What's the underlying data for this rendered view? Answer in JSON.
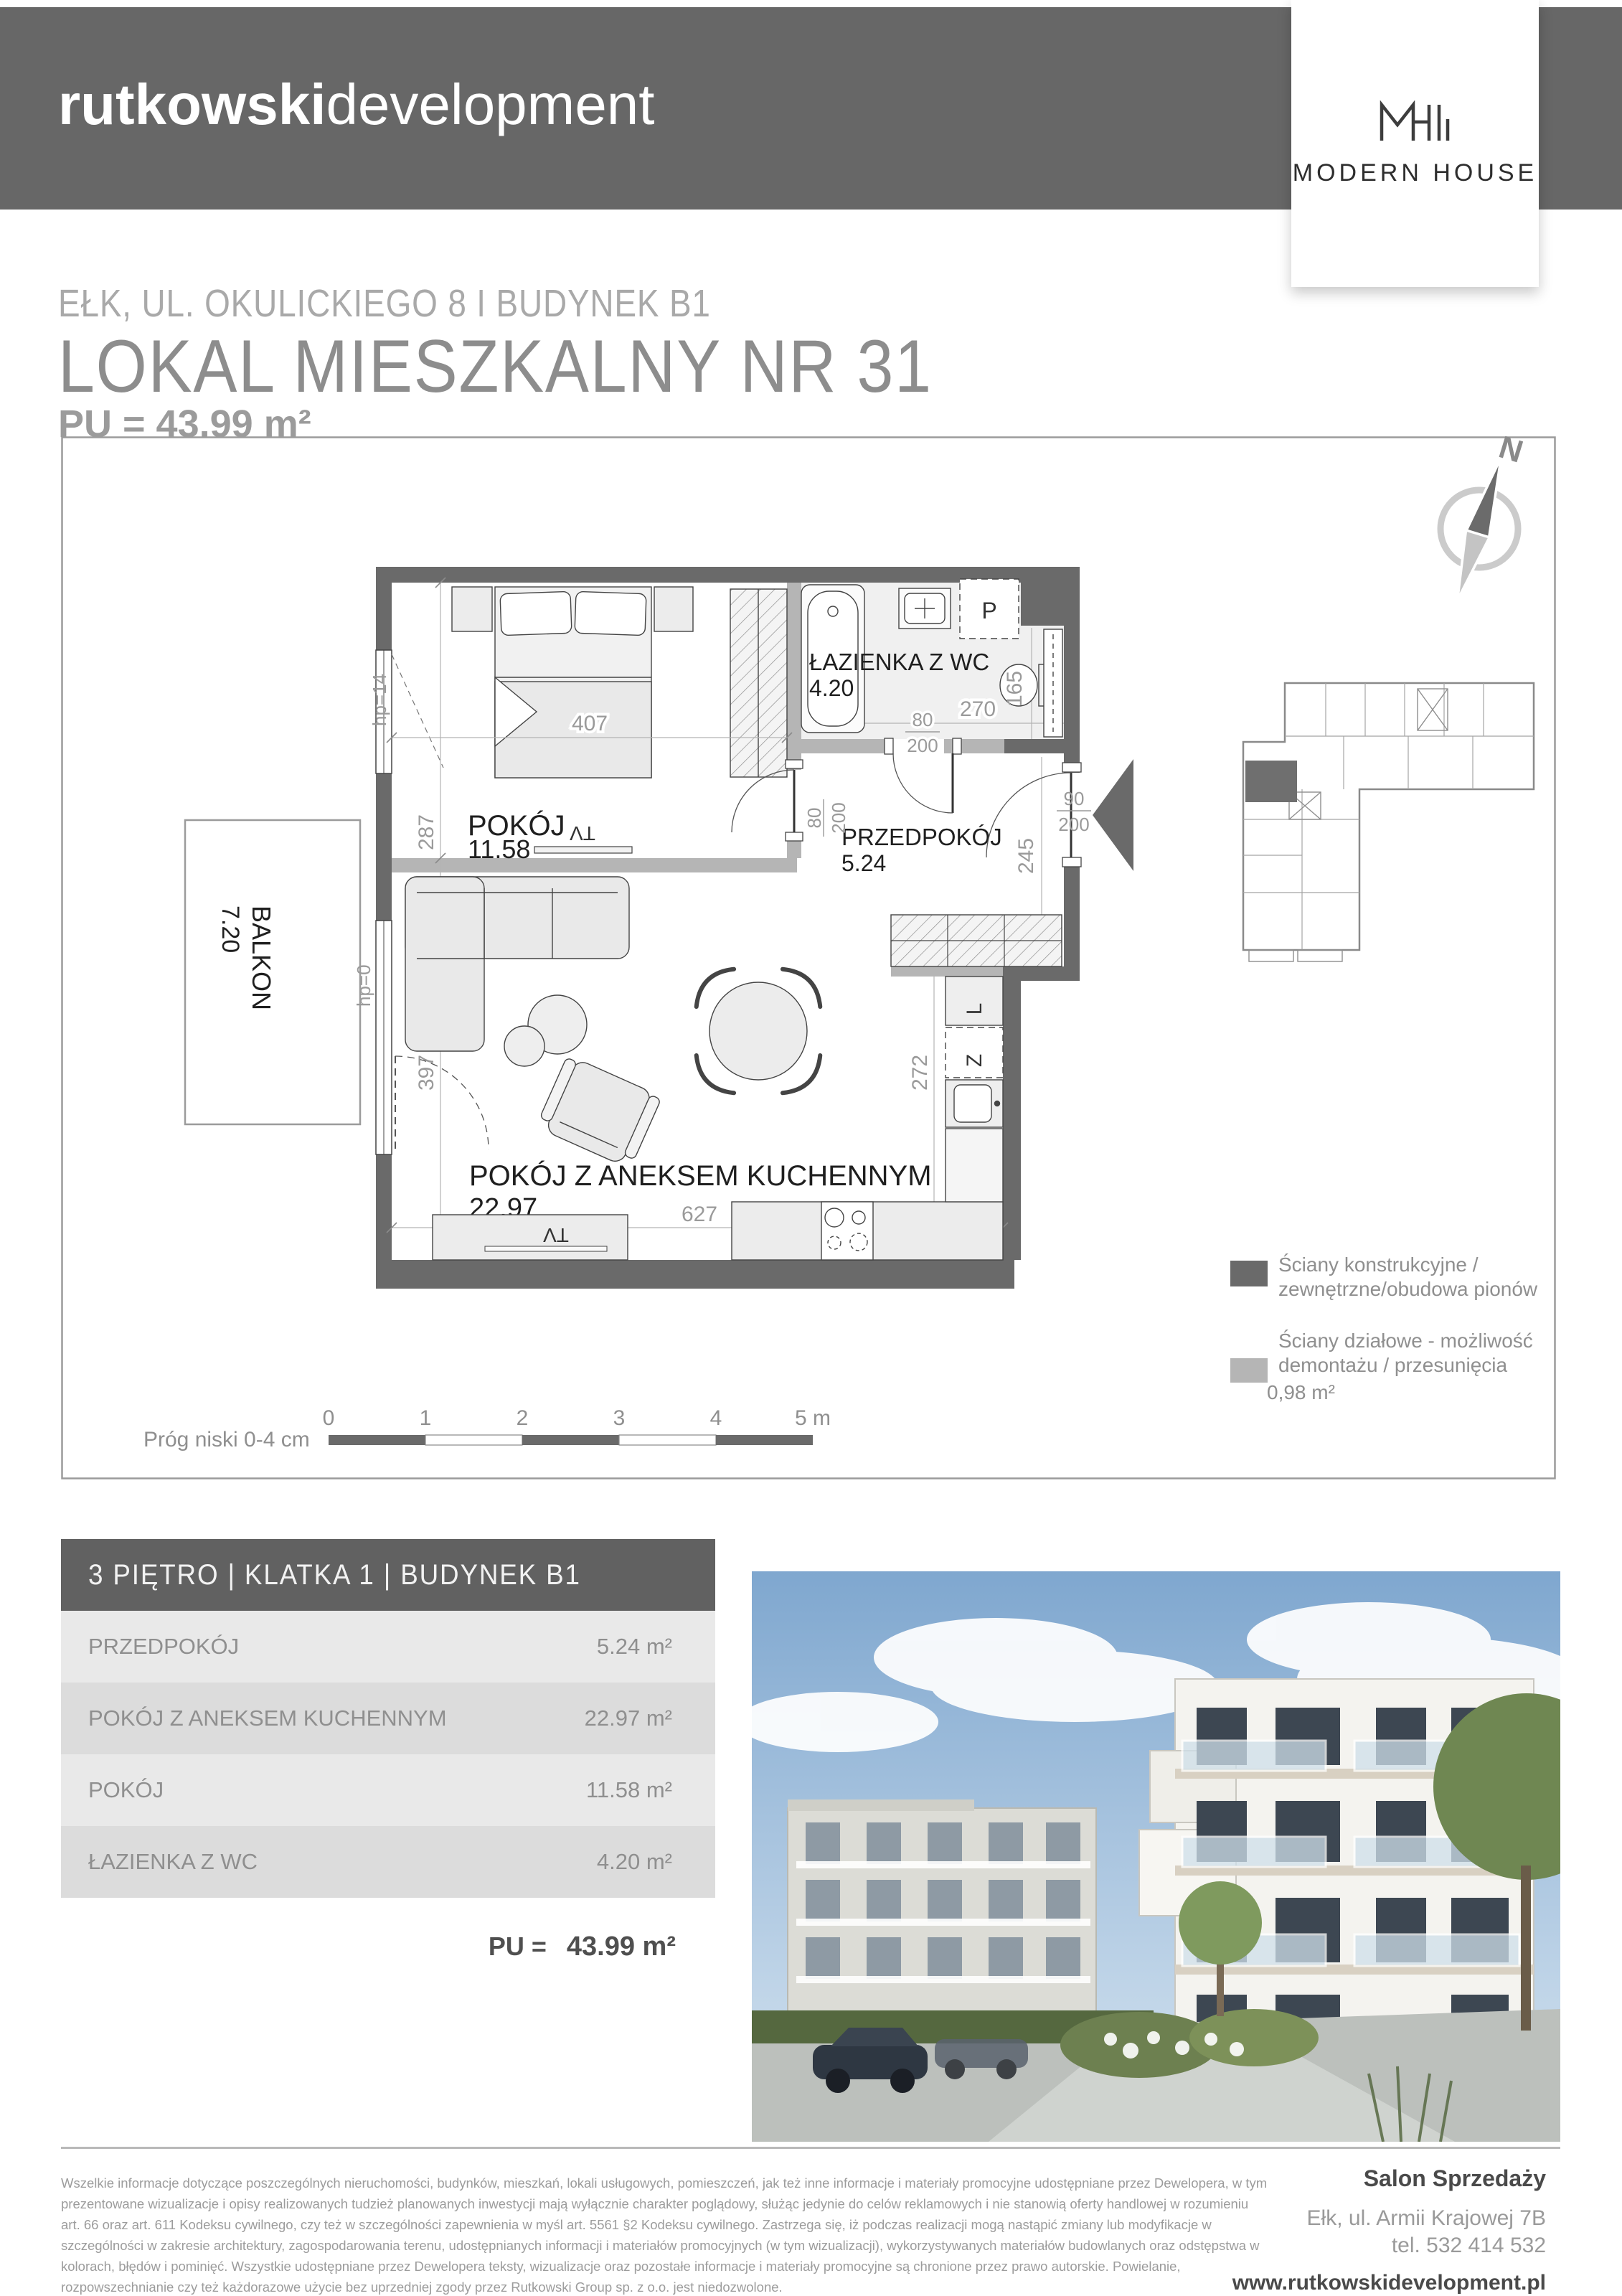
{
  "header": {
    "brand_bold": "rutkowski",
    "brand_light": "development"
  },
  "logo_card": {
    "name": "MODERN HOUSE"
  },
  "title": {
    "line1": "EŁK, UL. OKULICKIEGO 8 I BUDYNEK B1",
    "line2": "LOKAL MIESZKALNY NR 31",
    "pu": "PU = 43.99 m²"
  },
  "plan": {
    "compass_n": "N",
    "rooms": {
      "pokoj": {
        "name": "POKÓJ",
        "area": "11.58"
      },
      "lazienka": {
        "name": "ŁAZIENKA Z WC",
        "area": "4.20"
      },
      "przedpokoj": {
        "name": "PRZEDPOKÓJ",
        "area": "5.24"
      },
      "salon": {
        "name": "POKÓJ Z ANEKSEM KUCHENNYM",
        "area": "22.97"
      },
      "balkon": {
        "name": "BALKON",
        "area": "7.20"
      }
    },
    "dims": {
      "d407": "407",
      "d287": "287",
      "d270": "270",
      "d165": "165",
      "d245": "245",
      "d272": "272",
      "d627": "627",
      "d397": "397"
    },
    "door_dims": {
      "w80": "80",
      "w90": "90",
      "h200": "200"
    },
    "hp": {
      "window": "hp=14",
      "balcony": "hp=0"
    },
    "appliances": {
      "washer": "P",
      "fridge": "L",
      "dishwasher": "Z",
      "tv": "TV"
    },
    "scale": {
      "ticks": [
        "0",
        "1",
        "2",
        "3",
        "4",
        "5 m"
      ],
      "note": "Próg niski 0-4 cm"
    },
    "legend": {
      "item1_line1": "Ściany konstrukcyjne /",
      "item1_line2": "zewnętrzne/obudowa pionów",
      "item2_line1": "Ściany działowe - możliwość",
      "item2_line2": "demontażu / przesunięcia",
      "item2_area": "0,98  m²"
    }
  },
  "table": {
    "header": "3 PIĘTRO | KLATKA 1 | BUDYNEK B1",
    "rows": [
      {
        "name": "PRZEDPOKÓJ",
        "area": "5.24 m²"
      },
      {
        "name": "POKÓJ Z ANEKSEM KUCHENNYM",
        "area": "22.97 m²"
      },
      {
        "name": "POKÓJ",
        "area": "11.58 m²"
      },
      {
        "name": "ŁAZIENKA Z WC",
        "area": "4.20 m²"
      }
    ],
    "total_label": "PU =",
    "total_value": "43.99 m²"
  },
  "footer": {
    "legal": [
      "Wszelkie informacje dotyczące poszczególnych nieruchomości, budynków, mieszkań, lokali usługowych, pomieszczeń, jak też inne informacje i materiały promocyjne udostępniane przez Dewelopera, w tym",
      "prezentowane wizualizacje i opisy realizowanych tudzież planowanych inwestycji mają wyłącznie charakter poglądowy, służąc jedynie do celów reklamowych i nie stanowią oferty handlowej w rozumieniu",
      "art. 66 oraz art. 611 Kodeksu cywilnego, czy też w szczególności zapewnienia w myśl art. 5561 §2 Kodeksu cywilnego. Zastrzega się, iż podczas realizacji mogą nastąpić zmiany lub modyfikacje w",
      "szczególności w zakresie architektury, zagospodarowania terenu, udostępnianych informacji i materiałów promocyjnych (w tym wizualizacji), wykorzystywanych materiałów budowlanych oraz odstępstwa w",
      "kolorach, błędów i pominięć. Wszystkie udostępniane przez Dewelopera teksty, wizualizacje oraz pozostałe informacje i materiały promocyjne są chronione przez prawo autorskie. Powielanie,",
      "rozpowszechnianie czy też każdorazowe użycie bez uprzedniej zgody przez Rutkowski Group sp. z o.o. jest niedozwolone."
    ],
    "salon": {
      "title": "Salon Sprzedaży",
      "address": "Ełk, ul. Armii Krajowej 7B",
      "phone": "tel. 532 414 532",
      "site": "www.rutkowskidevelopment.pl"
    }
  }
}
